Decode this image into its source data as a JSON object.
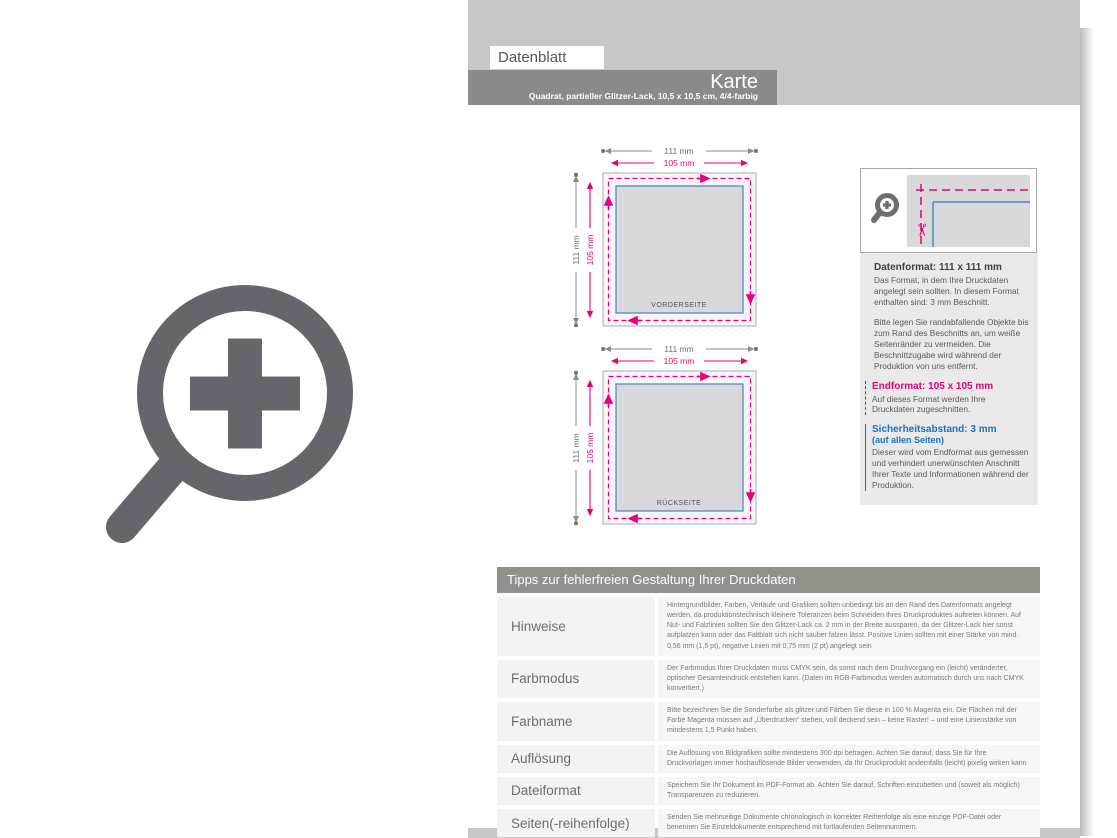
{
  "header": {
    "tab_label": "Datenblatt",
    "title": "Karte",
    "subtitle": "Quadrat, partieller Glitzer-Lack, 10,5 x 10,5 cm, 4/4-farbig"
  },
  "diagrams": {
    "outer_width": "111 mm",
    "inner_width": "105 mm",
    "outer_height": "111 mm",
    "inner_height": "105 mm",
    "front_label": "VORDERSEITE",
    "back_label": "RÜCKSEITE"
  },
  "info": {
    "datenformat_heading": "Datenformat: 111 x 111 mm",
    "datenformat_body": "Das Format, in dem Ihre Druckdaten angelegt sein sollten. In diesem Format enthalten sind: 3 mm Beschnitt.",
    "bleed_note": "Bitte legen Sie randabfallende Objekte bis zum Rand des Beschnitts an, um weiße Seitenränder zu vermeiden. Die Beschnittzugabe wird während der Produktion von uns entfernt.",
    "endformat_heading": "Endformat: 105 x 105 mm",
    "endformat_body": "Auf dieses Format werden Ihre Druckdaten zugeschnitten.",
    "sicherheit_heading": "Sicherheitsabstand: 3 mm",
    "sicherheit_sub": "(auf allen Seiten)",
    "sicherheit_body": "Dieser wird vom Endformat aus gemessen und verhindert unerwünschten Anschnitt Ihrer Texte und Informationen während der Produktion."
  },
  "tips": {
    "header": "Tipps zur fehlerfreien Gestaltung Ihrer Druckdaten",
    "rows": [
      {
        "label": "Hinweise",
        "text": "Hintergrundbilder, Farben, Verläufe und Grafiken sollten unbedingt bis an den Rand des Datenformats angelegt werden, da produktionstechnisch kleinere Toleranzen beim Schneiden Ihres Druckproduktes auftreten können. Auf Nut- und Falzlinien sollten Sie den Glitzer-Lack ca. 2 mm in der Breite aussparen, da der Glitzer-Lack hier sonst aufplatzen kann oder das Faltblatt sich nicht sauber falzen lässt. Positive Linien sollten mit einer Stärke von mind. 0,56 mm (1,5 pt), negative Linien mit 0,75 mm (2 pt) angelegt sein"
      },
      {
        "label": "Farbmodus",
        "text": "Der Farbmodus Ihrer Druckdaten muss CMYK sein, da sonst nach dem Druckvorgang ein (leicht) veränderter, optischer Gesamteindruck entstehen kann. (Daten im RGB-Farbmodus werden automatisch durch uns nach CMYK konvertiert.)"
      },
      {
        "label": "Farbname",
        "text": "Bitte bezeichnen Sie die Sonderfarbe als glitzer und Färben Sie diese in 100 % Magenta ein. Die Flächen mit der Farbe Magenta müssen auf „Überdrucken“ stehen, voll deckend sein – keine Raster! – und eine Linienstärke von mindestens 1,5 Punkt haben."
      },
      {
        "label": "Auflösung",
        "text": "Die Auflösung von Bildgrafiken sollte mindestens 300 dpi betragen. Achten Sie darauf, dass Sie für Ihre Druckvorlagen immer hochauflösende Bilder verwenden, da Ihr Druckprodukt andernfalls (leicht) pixelig wirken kann"
      },
      {
        "label": "Dateiformat",
        "text": "Speichern Sie Ihr Dokument im PDF-Format ab. Achten Sie darauf, Schriften einzubetten und (soweit als möglich) Transparenzen zu reduzieren."
      },
      {
        "label": "Seiten(-reihenfolge)",
        "text": "Senden Sie mehrseitige Dokumente chronologisch in korrekter Reihenfolge als eine einzige PDF-Datei oder benennen Sie Einzeldokumente entsprechend mit fortlaufenden Seitennummern."
      }
    ]
  },
  "icons": {
    "scissors_glyph": "✂",
    "zoom_icon": "magnifier-plus"
  },
  "colors": {
    "magenta": "#e6007e",
    "blue": "#1d71b8",
    "band_gray": "#c7c7c6",
    "bar_gray": "#8a8b86",
    "icon_gray": "#63676b"
  }
}
